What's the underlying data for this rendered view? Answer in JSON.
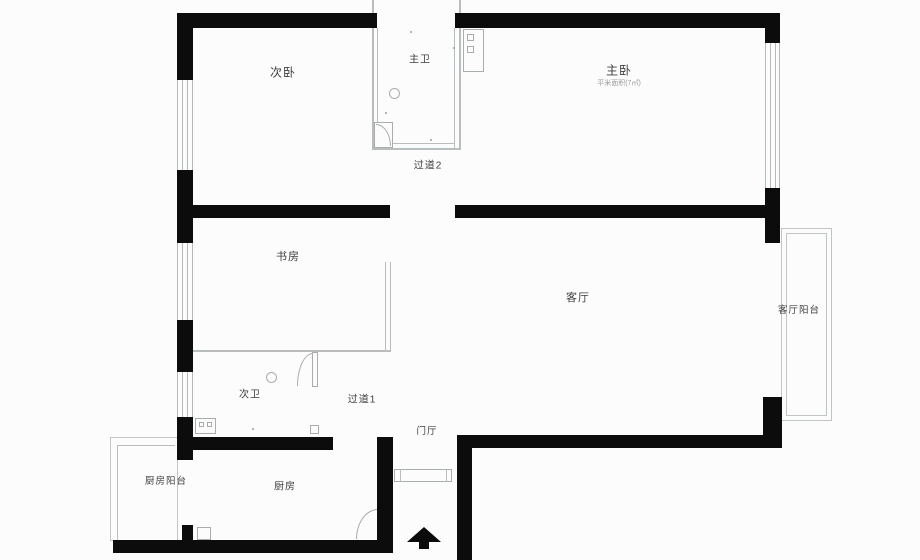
{
  "floorplan": {
    "colors": {
      "wall": "#0c0c0c",
      "thin_line": "#b9bdbd",
      "label": "#3f3f3f",
      "background": "#fcfcfc"
    },
    "rooms": {
      "secondary_bedroom": "次卧",
      "master_bathroom": "主卫",
      "master_bedroom": "主卧",
      "master_bedroom_note": "平米面积(7㎡)",
      "corridor_2": "过道2",
      "study": "书房",
      "living_room": "客厅",
      "living_balcony": "客厅阳台",
      "secondary_bathroom": "次卫",
      "corridor_1": "过道1",
      "entrance_hall": "门厅",
      "kitchen_balcony": "厨房阳台",
      "kitchen": "厨房"
    },
    "icons": {
      "entry_arrow": "entry-arrow"
    }
  }
}
